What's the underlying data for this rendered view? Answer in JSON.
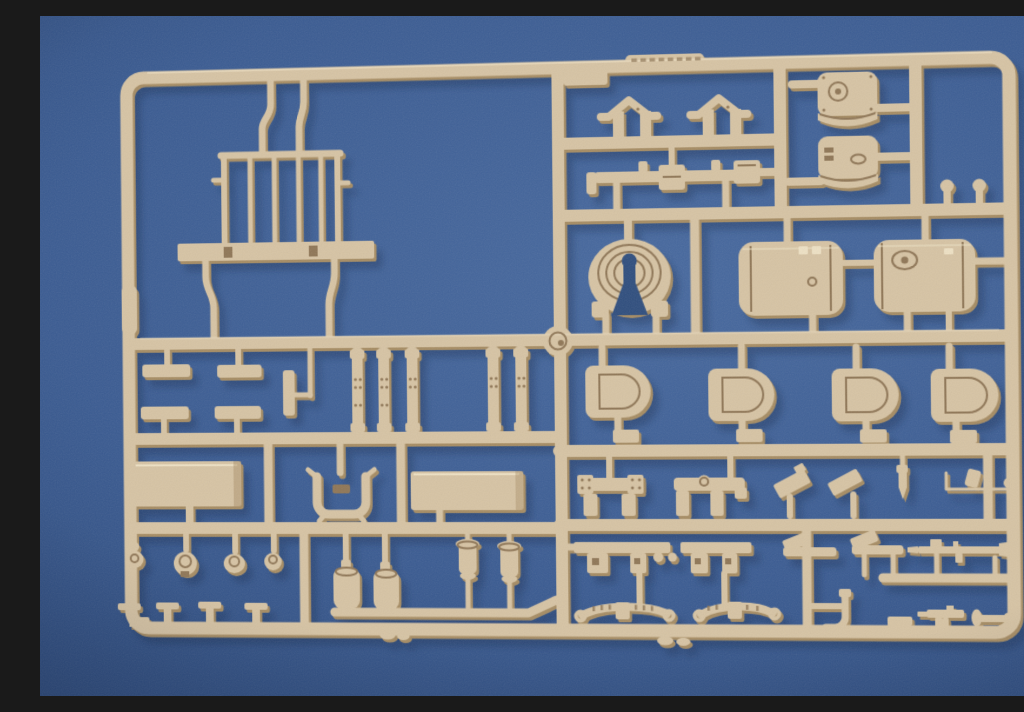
{
  "scene": {
    "type": "photograph",
    "subject": "Tan injection-molded model kit sprue (parts tree) lying on a blue fabric surface",
    "surface": "blue textured fabric backdrop",
    "sprue_material": "dark-yellow tan styrene plastic",
    "legible_text": "none - the embossed label tab on the top runner is illegible"
  },
  "colors": {
    "bg-light": "#47699f",
    "bg-mid": "#3a5b92",
    "bg-deep": "#2a4777",
    "hole": "#2f4e7e",
    "sprue": "#d7c4a4",
    "sprue-light": "#eee1c4",
    "sprue-edge": "#a68c63",
    "sprue-detail": "#8f7656",
    "cast-shadow": "#16294d"
  },
  "sprue": {
    "frame": "rounded rectangular outer runner with internal cross runners",
    "injection_gate": "round gate boss at the center of the middle runner",
    "embossed_label": {
      "present": true,
      "legible": false
    },
    "parts": [
      {
        "name": "railing-rack",
        "qty": 1,
        "area": "top-left"
      },
      {
        "name": "roof-shaped-bracket",
        "qty": 2,
        "area": "top-center"
      },
      {
        "name": "barrel-tool-assembly",
        "qty": 1,
        "area": "top-center"
      },
      {
        "name": "curved-fender-shell",
        "qty": 2,
        "area": "top-right"
      },
      {
        "name": "mushroom-head-pin",
        "qty": 2,
        "area": "top-right"
      },
      {
        "name": "cable-drum-horseshoe",
        "qty": 1,
        "area": "center"
      },
      {
        "name": "cylindrical-fuel-tank",
        "qty": 2,
        "area": "center-right"
      },
      {
        "name": "flat-t-bar",
        "qty": 4,
        "area": "mid-left"
      },
      {
        "name": "vertical-t-bar",
        "qty": 1,
        "area": "mid-left"
      },
      {
        "name": "riveted-spring-bar",
        "qty": 5,
        "area": "mid-center"
      },
      {
        "name": "storage-box",
        "qty": 1,
        "area": "mid-left"
      },
      {
        "name": "u-channel-bracket",
        "qty": 1,
        "area": "mid-center"
      },
      {
        "name": "flat-panel-lid",
        "qty": 1,
        "area": "mid-center"
      },
      {
        "name": "ball-pin",
        "qty": 1,
        "area": "lower-left"
      },
      {
        "name": "domed-cap",
        "qty": 3,
        "area": "lower-left"
      },
      {
        "name": "small-canister",
        "qty": 2,
        "area": "lower-center-left"
      },
      {
        "name": "flanged-roller",
        "qty": 2,
        "area": "lower-center"
      },
      {
        "name": "t-head-pin",
        "qty": 4,
        "area": "bottom-left"
      },
      {
        "name": "d-shaped-hatch-pad",
        "qty": 4,
        "area": "center-right"
      },
      {
        "name": "bolted-end-bracket",
        "qty": 1,
        "area": "lower-right"
      },
      {
        "name": "domed-link-bar",
        "qty": 1,
        "area": "lower-right"
      },
      {
        "name": "angled-flap",
        "qty": 2,
        "area": "lower-right"
      },
      {
        "name": "tapered-pin",
        "qty": 1,
        "area": "lower-right"
      },
      {
        "name": "mirror-arm-rod",
        "qty": 1,
        "area": "lower-right"
      },
      {
        "name": "notched-rail",
        "qty": 2,
        "area": "bottom-center"
      },
      {
        "name": "flap-rod",
        "qty": 2,
        "area": "bottom-right"
      },
      {
        "name": "detailed-tool-rod",
        "qty": 1,
        "area": "bottom-right"
      },
      {
        "name": "leaf-spring",
        "qty": 2,
        "area": "bottom-center"
      },
      {
        "name": "j-hook",
        "qty": 1,
        "area": "bottom-right"
      },
      {
        "name": "step-bracket",
        "qty": 1,
        "area": "bottom-right"
      },
      {
        "name": "pistol-shaped-part",
        "qty": 1,
        "area": "bottom-right"
      },
      {
        "name": "knob-rod",
        "qty": 1,
        "area": "bottom-right"
      }
    ]
  }
}
